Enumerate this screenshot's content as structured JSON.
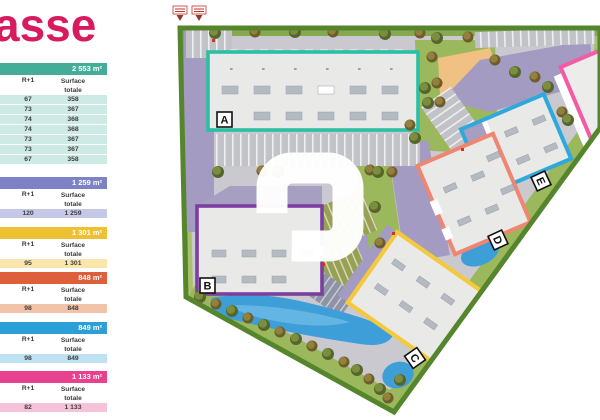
{
  "title": "asse",
  "title_color": "#d81b5e",
  "columns": {
    "floor": "R+1",
    "surface_line1": "Surface",
    "surface_line2": "totale"
  },
  "tables": [
    {
      "key": "a",
      "total": "2 553 m²",
      "header_color": "#44ad99",
      "row_color": "#cdeae4",
      "rows": [
        [
          "67",
          "358"
        ],
        [
          "73",
          "367"
        ],
        [
          "74",
          "368"
        ],
        [
          "74",
          "368"
        ],
        [
          "73",
          "367"
        ],
        [
          "73",
          "367"
        ],
        [
          "67",
          "358"
        ]
      ]
    },
    {
      "key": "b",
      "total": "1 259 m²",
      "header_color": "#7d81c6",
      "row_color": "#c6c8e8",
      "rows": [
        [
          "120",
          "1 259"
        ]
      ]
    },
    {
      "key": "c",
      "total": "1 301 m²",
      "header_color": "#eec133",
      "row_color": "#f9e6ac",
      "rows": [
        [
          "95",
          "1 301"
        ]
      ]
    },
    {
      "key": "d",
      "total": "848 m²",
      "header_color": "#dd5f3b",
      "row_color": "#f3c3a9",
      "rows": [
        [
          "98",
          "848"
        ]
      ]
    },
    {
      "key": "e",
      "total": "849 m²",
      "header_color": "#2c9fd6",
      "row_color": "#bfe2f3",
      "rows": [
        [
          "98",
          "849"
        ]
      ]
    },
    {
      "key": "f",
      "total": "1 133 m²",
      "header_color": "#e8418d",
      "row_color": "#f6c2da",
      "rows": [
        [
          "82",
          "1 133"
        ]
      ]
    }
  ],
  "plan": {
    "labels": {
      "a": "A",
      "b": "B",
      "c": "C",
      "d": "D",
      "e": "E"
    },
    "building_colors": {
      "a": "#2bbfa4",
      "b": "#7b3fa0",
      "c": "#f5c93c",
      "d": "#ee8672",
      "e": "#2fa9dc",
      "f": "#f45ba5"
    },
    "ground_colors": {
      "site_band": "#55852c",
      "grass": "#9cb85c",
      "asphalt": "#c9c9cf",
      "walkway": "#a39bc1",
      "water": "#3e9fd8"
    }
  }
}
